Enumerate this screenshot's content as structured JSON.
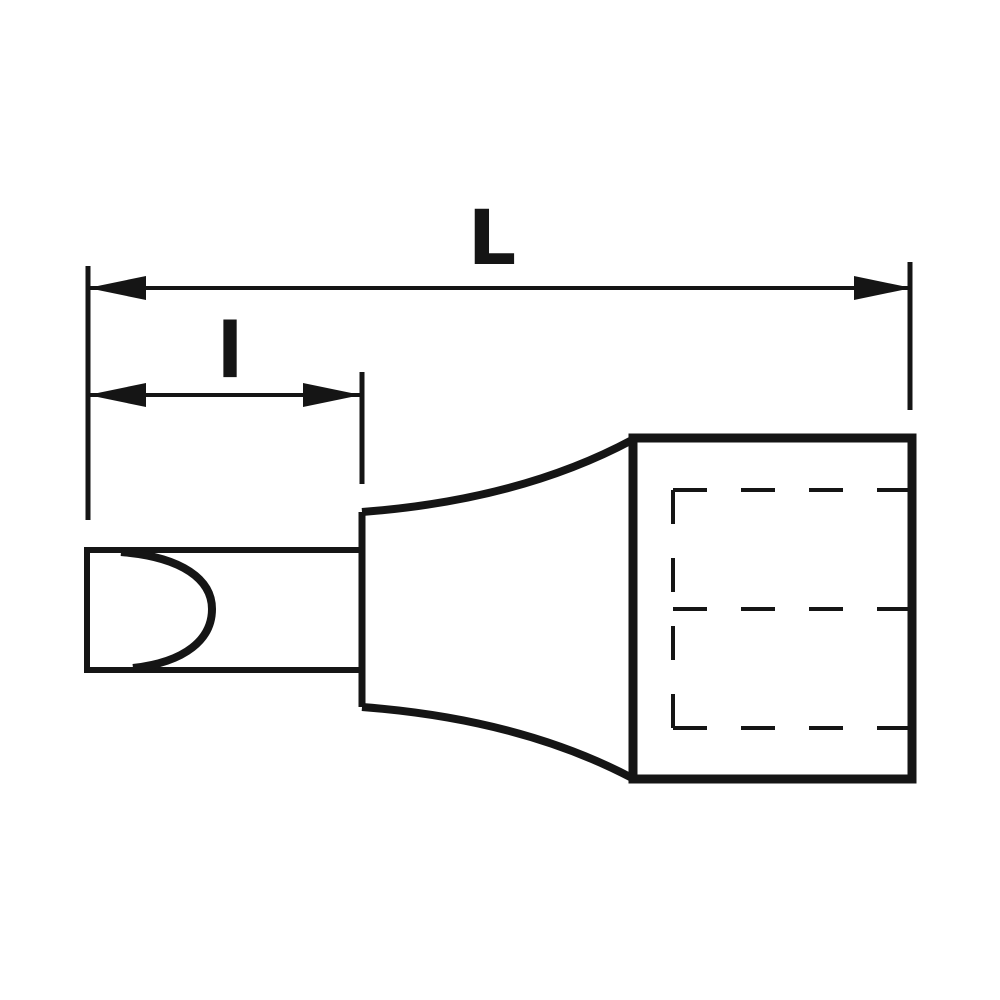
{
  "drawing": {
    "labels": {
      "overall_length": "L",
      "tip_length": "l"
    },
    "colors": {
      "line": "#151515",
      "background": "#ffffff"
    }
  }
}
